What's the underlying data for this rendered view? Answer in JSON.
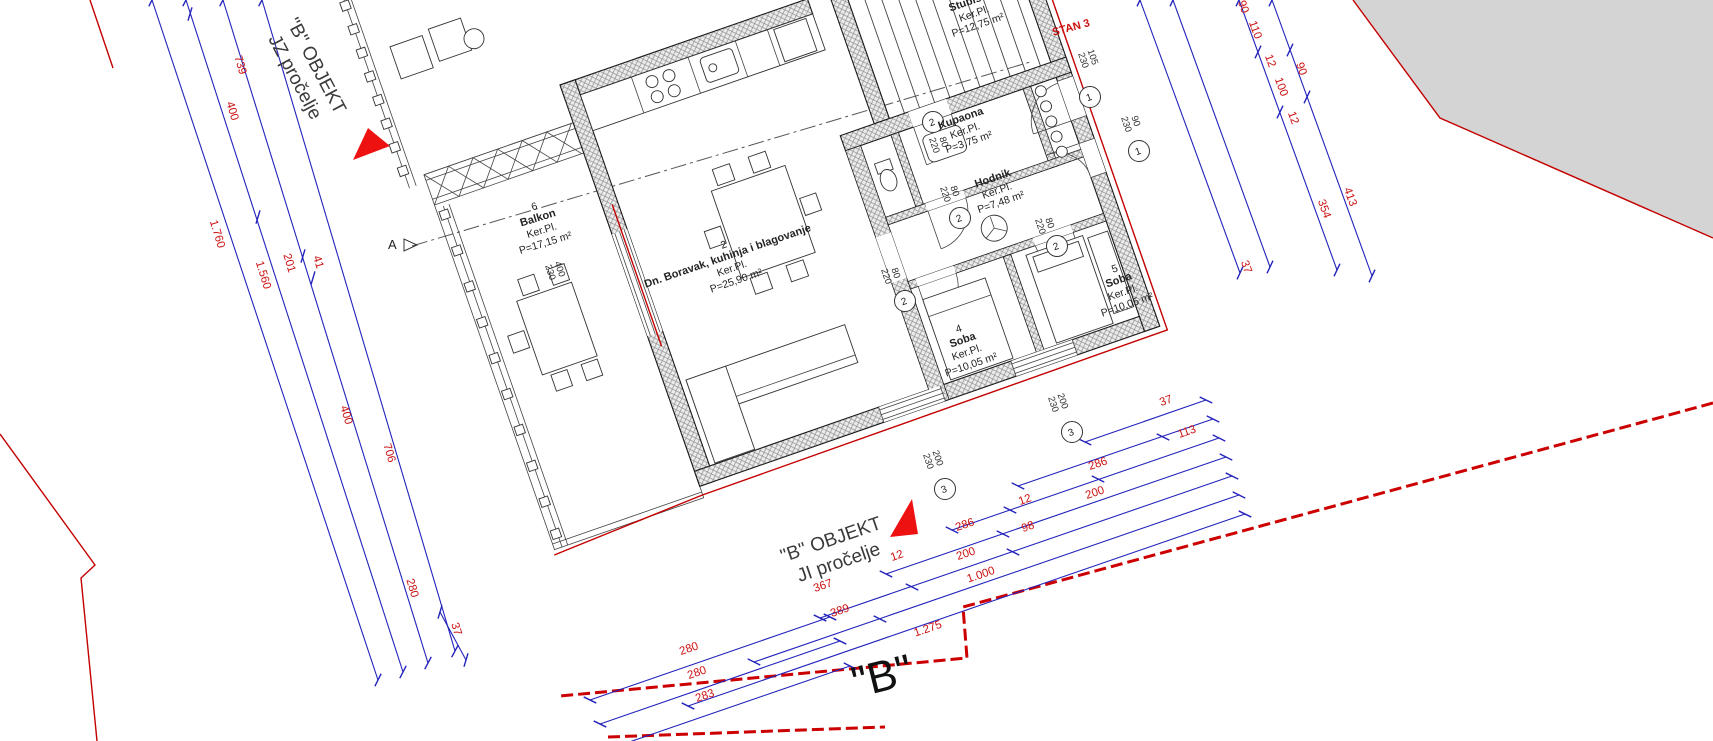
{
  "colors": {
    "dimension_line_blue": "#2323bb",
    "dimension_text_red": "#cc1111",
    "boundary_red": "#c40000",
    "triangle_red": "#ee1111",
    "neighbor_fill_gray": "#d4d4d4"
  },
  "titles": {
    "jz_facade": {
      "line1": "\"B\" OBJEKT",
      "line2": "JZ pročelje"
    },
    "ji_facade": {
      "line1": "\"B\" OBJEKT",
      "line2": "JI pročelje"
    },
    "stan_label": "STAN 3",
    "section_letter": "A",
    "bottom_cut_title": "\"B\""
  },
  "rooms": {
    "balkon": {
      "num": "6",
      "name": "Balkon",
      "floor": "Ker.Pl.",
      "area": "P=17,15 m²"
    },
    "living": {
      "num": "2",
      "name": "Dn. Boravak, kuhinja i blagovanje",
      "floor": "Ker.Pl.",
      "area": "P=25,90 m²"
    },
    "stubiste": {
      "num": "",
      "name": "Stubište",
      "floor": "Ker.Pl.",
      "area": "P=12,75 m²"
    },
    "kupaona": {
      "num": "",
      "name": "Kupaona",
      "floor": "Ker.Pl.",
      "area": "P=3,75 m²"
    },
    "hodnik": {
      "num": "",
      "name": "Hodnik",
      "floor": "Ker.Pl.",
      "area": "P=7,48 m²"
    },
    "soba4": {
      "num": "4",
      "name": "Soba",
      "floor": "Ker.Pl.",
      "area": "P=10,05 m²"
    },
    "soba5": {
      "num": "5",
      "name": "Soba",
      "floor": "Ker.Pl.",
      "area": "P=10,05 m²"
    }
  },
  "openings": {
    "pairs": [
      {
        "x": 1090,
        "y": 58,
        "rot": 71,
        "lines": [
          "105",
          "230"
        ]
      },
      {
        "x": 1133,
        "y": 122,
        "rot": 71,
        "lines": [
          "90",
          "230"
        ]
      },
      {
        "x": 941,
        "y": 143,
        "rot": 71,
        "lines": [
          "80",
          "220"
        ]
      },
      {
        "x": 952,
        "y": 192,
        "rot": 71,
        "lines": [
          "80",
          "220"
        ]
      },
      {
        "x": 893,
        "y": 274,
        "rot": 71,
        "lines": [
          "80",
          "220"
        ]
      },
      {
        "x": 1047,
        "y": 224,
        "rot": 71,
        "lines": [
          "80",
          "220"
        ]
      },
      {
        "x": 557,
        "y": 270,
        "rot": 71,
        "lines": [
          "400",
          "230"
        ]
      },
      {
        "x": 1060,
        "y": 402,
        "rot": 71,
        "lines": [
          "200",
          "230"
        ]
      },
      {
        "x": 935,
        "y": 459,
        "rot": 71,
        "lines": [
          "200",
          "230"
        ]
      }
    ],
    "refs": [
      {
        "x": 1090,
        "y": 97,
        "t": "1"
      },
      {
        "x": 1139,
        "y": 151,
        "t": "1"
      },
      {
        "x": 933,
        "y": 122,
        "t": "2"
      },
      {
        "x": 960,
        "y": 218,
        "t": "2"
      },
      {
        "x": 905,
        "y": 301,
        "t": "2"
      },
      {
        "x": 1057,
        "y": 246,
        "t": "2"
      },
      {
        "x": 1072,
        "y": 432,
        "t": "3"
      },
      {
        "x": 945,
        "y": 489,
        "t": "3"
      }
    ]
  },
  "dimensions": {
    "groups": [
      {
        "name": "left-chain",
        "rot": 73,
        "lines": [
          [
            152,
            0,
            378,
            680
          ],
          [
            186,
            0,
            403,
            672
          ],
          [
            223,
            0,
            428,
            663
          ],
          [
            262,
            0,
            455,
            651
          ],
          [
            440,
            612,
            466,
            660
          ]
        ],
        "mids": [
          [
            190,
            14
          ],
          [
            258,
            217
          ],
          [
            303,
            256
          ],
          [
            313,
            278
          ]
        ],
        "labels": [
          [
            "739",
            237,
            66
          ],
          [
            "400",
            229,
            112
          ],
          [
            "1.760",
            214,
            235
          ],
          [
            "1.560",
            260,
            276
          ],
          [
            "201",
            286,
            264
          ],
          [
            "41",
            315,
            263
          ],
          [
            "400",
            343,
            416
          ],
          [
            "706",
            386,
            454
          ],
          [
            "280",
            409,
            589
          ],
          [
            "37",
            453,
            630
          ]
        ]
      },
      {
        "name": "right-chain",
        "rot": 70,
        "lines": [
          [
            1140,
            0,
            1240,
            273
          ],
          [
            1173,
            0,
            1270,
            267
          ],
          [
            1239,
            0,
            1337,
            270
          ],
          [
            1272,
            0,
            1372,
            276
          ]
        ],
        "mids": [
          [
            1258,
            52
          ],
          [
            1280,
            112
          ],
          [
            1290,
            50
          ],
          [
            1307,
            97
          ]
        ],
        "labels": [
          [
            "90",
            1240,
            8
          ],
          [
            "110",
            1252,
            31
          ],
          [
            "12",
            1267,
            62
          ],
          [
            "100",
            1278,
            88
          ],
          [
            "90",
            1298,
            70
          ],
          [
            "12",
            1290,
            119
          ],
          [
            "413",
            1347,
            198
          ],
          [
            "354",
            1321,
            210
          ],
          [
            "37",
            1243,
            268
          ]
        ]
      },
      {
        "name": "bottom-chain",
        "rot": -19,
        "lines": [
          [
            1085,
            442,
            1206,
            400
          ],
          [
            1018,
            486,
            1213,
            419
          ],
          [
            952,
            530,
            1219,
            438
          ],
          [
            886,
            574,
            1226,
            457
          ],
          [
            820,
            618,
            1232,
            476
          ],
          [
            754,
            662,
            1239,
            495
          ],
          [
            688,
            706,
            1245,
            514
          ],
          [
            590,
            700,
            830,
            617
          ],
          [
            600,
            724,
            840,
            641
          ],
          [
            612,
            748,
            850,
            666
          ]
        ],
        "mids": [
          [
            1163,
            437
          ],
          [
            1010,
            510
          ],
          [
            1098,
            479
          ],
          [
            1003,
            534
          ],
          [
            912,
            587
          ],
          [
            1013,
            552
          ],
          [
            880,
            619
          ]
        ],
        "labels": [
          [
            "37",
            1167,
            404
          ],
          [
            "286",
            1099,
            467
          ],
          [
            "113",
            1188,
            435
          ],
          [
            "12",
            1026,
            503
          ],
          [
            "200",
            1096,
            496
          ],
          [
            "286",
            966,
            528
          ],
          [
            "98",
            1029,
            530
          ],
          [
            "12",
            898,
            559
          ],
          [
            "200",
            967,
            557
          ],
          [
            "367",
            824,
            589
          ],
          [
            "1.000",
            982,
            578
          ],
          [
            "389",
            841,
            614
          ],
          [
            "1.275",
            929,
            632
          ],
          [
            "280",
            690,
            652
          ],
          [
            "280",
            698,
            676
          ],
          [
            "283",
            706,
            699
          ]
        ]
      }
    ]
  }
}
